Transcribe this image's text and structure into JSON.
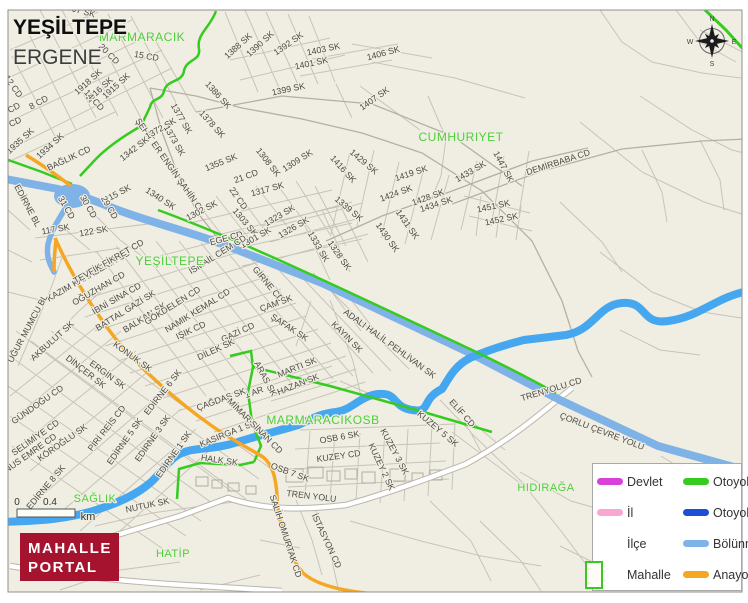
{
  "map": {
    "title_primary": "YEŞİLTEPE",
    "title_secondary": "ERGENE",
    "compass": {
      "n": "N",
      "e": "E",
      "s": "S",
      "w": "W"
    },
    "scale": {
      "zero": "0",
      "end": "0.4",
      "unit": "km"
    },
    "colors": {
      "background": "#f0eee2",
      "divided_road": "#7fb2e6",
      "river": "#45a7f0",
      "motorway_yid_green": "#35cc1f",
      "main_road_orange": "#f5a623",
      "area_label_green": "#4fce3c",
      "logo_red": "#a6132e",
      "devlet_magenta": "#d941d9",
      "il_pink": "#f8a8d0",
      "otoyol_blue": "#1d4ed8"
    },
    "area_labels": [
      {
        "t": "MARMARACIK",
        "x": 142,
        "y": 41,
        "s": 12
      },
      {
        "t": "CUMHURIYET",
        "x": 461,
        "y": 141,
        "s": 12
      },
      {
        "t": "YEŞİLTEPE",
        "x": 170,
        "y": 265,
        "s": 12
      },
      {
        "t": "MARMARACIKOSB",
        "x": 323,
        "y": 424,
        "s": 12
      },
      {
        "t": "SAĞLIK",
        "x": 95,
        "y": 502,
        "s": 11
      },
      {
        "t": "HIDIRAĞA",
        "x": 546,
        "y": 491,
        "s": 11
      },
      {
        "t": "HATİP",
        "x": 173,
        "y": 557,
        "s": 11
      }
    ],
    "street_labels": [
      {
        "t": "1907 SK",
        "x": 78,
        "y": 13,
        "r": 15
      },
      {
        "t": "15 CD",
        "x": 146,
        "y": 59,
        "r": 10
      },
      {
        "t": "20 CD",
        "x": 107,
        "y": 56,
        "r": 45
      },
      {
        "t": "1918 SK",
        "x": 90,
        "y": 84,
        "r": -42
      },
      {
        "t": "1916 SK",
        "x": 101,
        "y": 92,
        "r": -42
      },
      {
        "t": "1915 SK",
        "x": 118,
        "y": 88,
        "r": -42
      },
      {
        "t": "14 CD",
        "x": 92,
        "y": 102,
        "r": 48
      },
      {
        "t": "12 CD",
        "x": 11,
        "y": 88,
        "r": 55
      },
      {
        "t": "8 CD",
        "x": 40,
        "y": 105,
        "r": -28
      },
      {
        "t": "6 CD",
        "x": 12,
        "y": 112,
        "r": -28
      },
      {
        "t": "4 CD",
        "x": 13,
        "y": 126,
        "r": -25
      },
      {
        "t": "1935 SK",
        "x": 22,
        "y": 143,
        "r": -42
      },
      {
        "t": "1934 SK",
        "x": 52,
        "y": 148,
        "r": -42
      },
      {
        "t": "ŞEHİT ER ENGİN ŞAHİN CD",
        "x": 168,
        "y": 168,
        "r": 55
      },
      {
        "t": "BAĞLIK CD",
        "x": 70,
        "y": 161,
        "r": -25
      },
      {
        "t": "1342 SK",
        "x": 136,
        "y": 151,
        "r": -38
      },
      {
        "t": "1388 SK",
        "x": 240,
        "y": 48,
        "r": -42
      },
      {
        "t": "1390 SK",
        "x": 262,
        "y": 46,
        "r": -42
      },
      {
        "t": "1392 SK",
        "x": 290,
        "y": 46,
        "r": -35
      },
      {
        "t": "1403 SK",
        "x": 324,
        "y": 52,
        "r": -12
      },
      {
        "t": "1401 SK",
        "x": 312,
        "y": 66,
        "r": -12
      },
      {
        "t": "1406 SK",
        "x": 384,
        "y": 56,
        "r": -15
      },
      {
        "t": "1399 SK",
        "x": 289,
        "y": 92,
        "r": -12
      },
      {
        "t": "1407 SK",
        "x": 376,
        "y": 101,
        "r": -35
      },
      {
        "t": "1386 SK",
        "x": 216,
        "y": 97,
        "r": 48
      },
      {
        "t": "1377 SK",
        "x": 179,
        "y": 120,
        "r": 60
      },
      {
        "t": "1372 SK",
        "x": 162,
        "y": 131,
        "r": -30
      },
      {
        "t": "1373 SK",
        "x": 172,
        "y": 142,
        "r": 60
      },
      {
        "t": "1378 SK",
        "x": 210,
        "y": 126,
        "r": 48
      },
      {
        "t": "1355 SK",
        "x": 222,
        "y": 165,
        "r": -22
      },
      {
        "t": "1308 SK",
        "x": 266,
        "y": 164,
        "r": 52
      },
      {
        "t": "1309 SK",
        "x": 299,
        "y": 163,
        "r": -32
      },
      {
        "t": "21 CD",
        "x": 247,
        "y": 179,
        "r": -20
      },
      {
        "t": "22 CD",
        "x": 236,
        "y": 200,
        "r": 55
      },
      {
        "t": "1317 SK",
        "x": 268,
        "y": 192,
        "r": -15
      },
      {
        "t": "1340 SK",
        "x": 159,
        "y": 201,
        "r": 33
      },
      {
        "t": "115 SK",
        "x": 119,
        "y": 196,
        "r": -28
      },
      {
        "t": "31 CD",
        "x": 64,
        "y": 209,
        "r": 60
      },
      {
        "t": "30 CD",
        "x": 86,
        "y": 208,
        "r": 60
      },
      {
        "t": "29 CD",
        "x": 107,
        "y": 209,
        "r": 60
      },
      {
        "t": "117 SK",
        "x": 56,
        "y": 232,
        "r": -10
      },
      {
        "t": "122 SK",
        "x": 94,
        "y": 234,
        "r": -10
      },
      {
        "t": "1302 SK",
        "x": 203,
        "y": 213,
        "r": -28
      },
      {
        "t": "1303 SK",
        "x": 243,
        "y": 224,
        "r": 50
      },
      {
        "t": "1301 SK",
        "x": 257,
        "y": 240,
        "r": -30
      },
      {
        "t": "EGE CD",
        "x": 227,
        "y": 241,
        "r": -15
      },
      {
        "t": "1323 SK",
        "x": 281,
        "y": 218,
        "r": -30
      },
      {
        "t": "1326 SK",
        "x": 295,
        "y": 230,
        "r": -30
      },
      {
        "t": "1333 SK",
        "x": 316,
        "y": 248,
        "r": 60
      },
      {
        "t": "1328 SK",
        "x": 337,
        "y": 257,
        "r": 55
      },
      {
        "t": "1339 SK",
        "x": 347,
        "y": 211,
        "r": 40
      },
      {
        "t": "1416 SK",
        "x": 341,
        "y": 171,
        "r": 48
      },
      {
        "t": "1429 SK",
        "x": 362,
        "y": 164,
        "r": 40
      },
      {
        "t": "1419 SK",
        "x": 412,
        "y": 176,
        "r": -18
      },
      {
        "t": "1424 SK",
        "x": 397,
        "y": 196,
        "r": -20
      },
      {
        "t": "1428 SK",
        "x": 429,
        "y": 200,
        "r": -20
      },
      {
        "t": "1434 SK",
        "x": 437,
        "y": 207,
        "r": -18
      },
      {
        "t": "1433 SK",
        "x": 472,
        "y": 174,
        "r": -30
      },
      {
        "t": "1447 SK",
        "x": 501,
        "y": 168,
        "r": 62
      },
      {
        "t": "1431 SK",
        "x": 405,
        "y": 226,
        "r": 55
      },
      {
        "t": "1430 SK",
        "x": 385,
        "y": 239,
        "r": 55
      },
      {
        "t": "DEMİRBABA CD",
        "x": 559,
        "y": 165,
        "r": -18
      },
      {
        "t": "1451 SK",
        "x": 494,
        "y": 209,
        "r": -12
      },
      {
        "t": "1452 SK",
        "x": 502,
        "y": 222,
        "r": -12
      },
      {
        "t": "EDİRNE BL",
        "x": 25,
        "y": 207,
        "r": 62
      },
      {
        "t": "KAZIM KARABEKİR CD",
        "x": 90,
        "y": 278,
        "r": -30
      },
      {
        "t": "TEVFİK FİKRET CD",
        "x": 110,
        "y": 264,
        "r": -30
      },
      {
        "t": "OĞUZHAN CD",
        "x": 100,
        "y": 291,
        "r": -30
      },
      {
        "t": "İBNİ SİNA CD",
        "x": 118,
        "y": 301,
        "r": -30
      },
      {
        "t": "BATTAL GAZİ SK",
        "x": 127,
        "y": 313,
        "r": -32
      },
      {
        "t": "BALKAN SK",
        "x": 146,
        "y": 320,
        "r": -32
      },
      {
        "t": "GÖKDELEN CD",
        "x": 174,
        "y": 308,
        "r": -32
      },
      {
        "t": "NAMIK KEMAL CD",
        "x": 199,
        "y": 313,
        "r": -32
      },
      {
        "t": "İSMAİL CEM CD",
        "x": 219,
        "y": 257,
        "r": -32
      },
      {
        "t": "GİRNE CD",
        "x": 266,
        "y": 286,
        "r": 50
      },
      {
        "t": "ÇAM SK",
        "x": 277,
        "y": 306,
        "r": -20
      },
      {
        "t": "ŞAFAK SK",
        "x": 288,
        "y": 330,
        "r": 33
      },
      {
        "t": "IŞIK CD",
        "x": 192,
        "y": 333,
        "r": -25
      },
      {
        "t": "GAZİ CD",
        "x": 239,
        "y": 335,
        "r": -25
      },
      {
        "t": "DİLEK SK",
        "x": 217,
        "y": 352,
        "r": -25
      },
      {
        "t": "KAYIN SK",
        "x": 345,
        "y": 339,
        "r": 45
      },
      {
        "t": "ADALI HALİL PEHLİVAN SK",
        "x": 388,
        "y": 346,
        "r": 36
      },
      {
        "t": "MARTI SK",
        "x": 298,
        "y": 370,
        "r": -22
      },
      {
        "t": "HAZAN SK",
        "x": 299,
        "y": 387,
        "r": -22
      },
      {
        "t": "ARAS SK",
        "x": 263,
        "y": 380,
        "r": 62
      },
      {
        "t": "1 AR",
        "x": 255,
        "y": 395,
        "r": -20
      },
      {
        "t": "UĞUR MUMCU BL",
        "x": 30,
        "y": 330,
        "r": -62
      },
      {
        "t": "AKBULUT SK",
        "x": 54,
        "y": 343,
        "r": -42
      },
      {
        "t": "KONUK SK",
        "x": 131,
        "y": 359,
        "r": 36
      },
      {
        "t": "ERGİN SK",
        "x": 106,
        "y": 377,
        "r": 36
      },
      {
        "t": "DİNÇER SK",
        "x": 84,
        "y": 374,
        "r": 38
      },
      {
        "t": "GÜNDOĞU CD",
        "x": 39,
        "y": 407,
        "r": -35
      },
      {
        "t": "SELİMİYE CD",
        "x": 37,
        "y": 440,
        "r": -35
      },
      {
        "t": "KÖROĞLU SK",
        "x": 64,
        "y": 445,
        "r": -35
      },
      {
        "t": "YUNUS EMRE CD",
        "x": 27,
        "y": 459,
        "r": -35
      },
      {
        "t": "PİRİ REİS CD",
        "x": 109,
        "y": 430,
        "r": -52
      },
      {
        "t": "EDİRNE 5 SK",
        "x": 127,
        "y": 443,
        "r": -55
      },
      {
        "t": "EDİRNE 3 SK",
        "x": 155,
        "y": 440,
        "r": -55
      },
      {
        "t": "EDİRNE 1 SK",
        "x": 176,
        "y": 456,
        "r": -55
      },
      {
        "t": "EDİRNE 6 SK",
        "x": 165,
        "y": 394,
        "r": -52
      },
      {
        "t": "ÇAĞDAŞ SK",
        "x": 222,
        "y": 402,
        "r": -20
      },
      {
        "t": "EDİRNE 8 SK",
        "x": 48,
        "y": 489,
        "r": -50
      },
      {
        "t": "KASIRGA 1 SK",
        "x": 229,
        "y": 436,
        "r": -22
      },
      {
        "t": "MİMAR SİNAN CD",
        "x": 253,
        "y": 428,
        "r": 45
      },
      {
        "t": "OSB 6 SK",
        "x": 340,
        "y": 440,
        "r": -10
      },
      {
        "t": "KUZEY CD",
        "x": 339,
        "y": 459,
        "r": -8
      },
      {
        "t": "OSB 7 SK",
        "x": 289,
        "y": 475,
        "r": 20
      },
      {
        "t": "KUZEY 2 SK",
        "x": 379,
        "y": 468,
        "r": 65
      },
      {
        "t": "KUZEY 3 SK",
        "x": 392,
        "y": 453,
        "r": 62
      },
      {
        "t": "KUZEY 5 SK",
        "x": 436,
        "y": 431,
        "r": 40
      },
      {
        "t": "ELİF CD",
        "x": 460,
        "y": 415,
        "r": 48
      },
      {
        "t": "TRENYOLU CD",
        "x": 552,
        "y": 392,
        "r": -17
      },
      {
        "t": "ÇORLU ÇEVRE YOLU",
        "x": 601,
        "y": 434,
        "r": 21
      },
      {
        "t": "TREN YOLU",
        "x": 311,
        "y": 499,
        "r": 7
      },
      {
        "t": "İSTASYON CD",
        "x": 324,
        "y": 542,
        "r": 65
      },
      {
        "t": "SALİH OMURTAK CD",
        "x": 283,
        "y": 537,
        "r": 72
      },
      {
        "t": "HALK SK",
        "x": 219,
        "y": 463,
        "r": 8
      },
      {
        "t": "NUTUK SK",
        "x": 148,
        "y": 508,
        "r": -12
      }
    ]
  },
  "legend": {
    "rows": [
      {
        "l": {
          "label": "Devlet",
          "type": "line",
          "color": "#d941d9"
        },
        "r": {
          "label": "Otoyol-YİD",
          "type": "line",
          "color": "#35cc1f"
        }
      },
      {
        "l": {
          "label": "İl",
          "type": "line",
          "color": "#f8a8d0"
        },
        "r": {
          "label": "Otoyol",
          "type": "line",
          "color": "#1d4ed8"
        }
      },
      {
        "l": {
          "label": "İlçe",
          "type": "none",
          "color": ""
        },
        "r": {
          "label": "Bölünmüş Y",
          "type": "line",
          "color": "#7fb2e6"
        }
      },
      {
        "l": {
          "label": "Mahalle",
          "type": "rect",
          "color": "#35cc1f"
        },
        "r": {
          "label": "Anayol",
          "type": "line",
          "color": "#f5a623"
        }
      }
    ]
  },
  "logo": {
    "line1": "MAHALLE",
    "line2": "PORTAL"
  }
}
